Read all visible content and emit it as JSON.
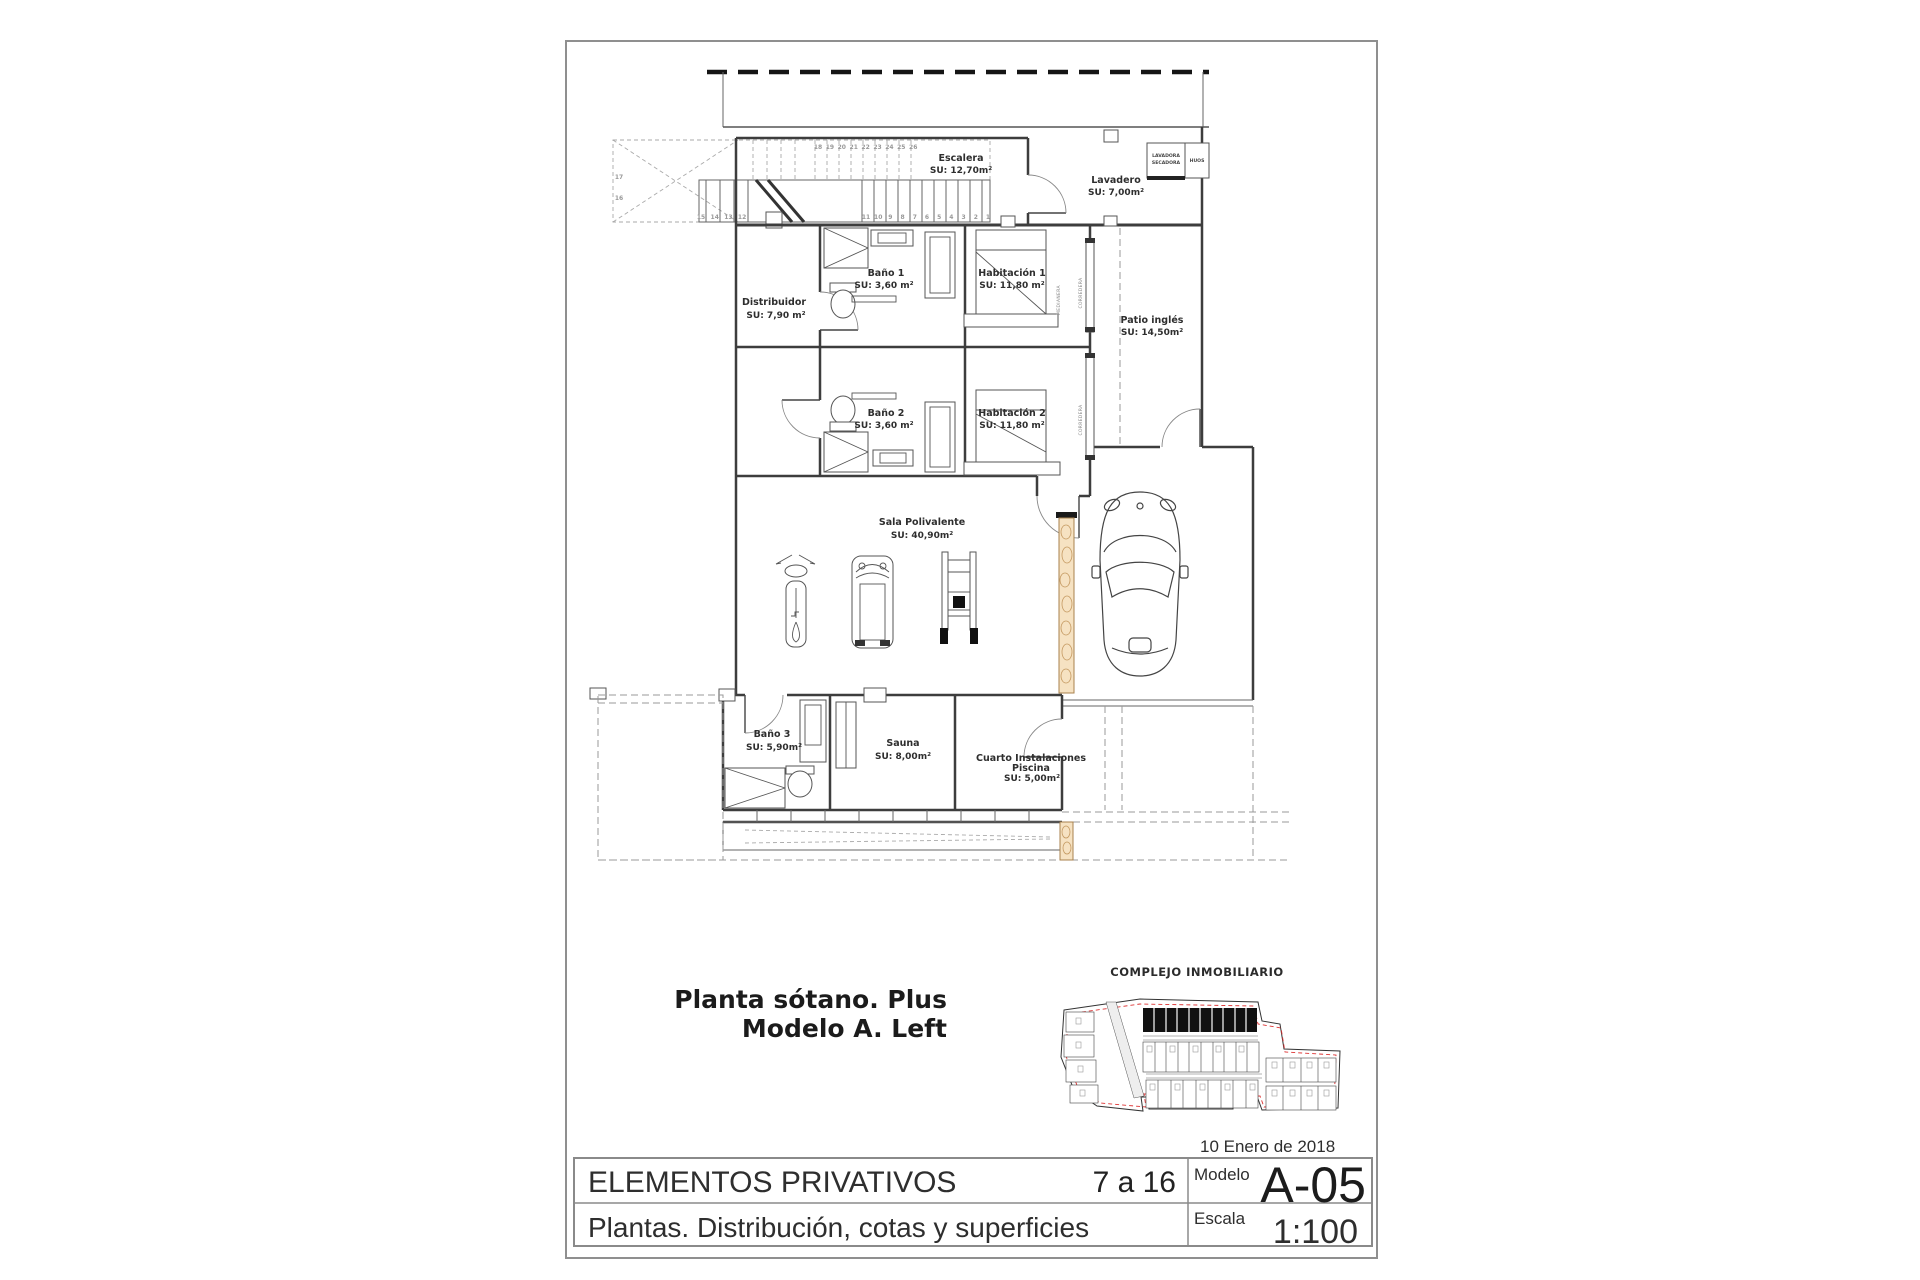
{
  "page": {
    "plan_title_line1": "Planta sótano. Plus",
    "plan_title_line2": "Modelo A. Left",
    "site_plan_title": "COMPLEJO INMOBILIARIO",
    "title_block": {
      "date": "10 Enero de 2018",
      "project": "ELEMENTOS PRIVATIVOS",
      "sheet_range": "7 a 16",
      "modelo_label": "Modelo",
      "modelo_value": "A-05",
      "subtitle": "Plantas. Distribución, cotas y superficies",
      "escala_label": "Escala",
      "escala_value": "1:100",
      "accent_color": "#f4470a"
    }
  },
  "plan": {
    "rooms": {
      "escalera": {
        "name": "Escalera",
        "area": "SU: 12,70m²"
      },
      "lavadero": {
        "name": "Lavadero",
        "area": "SU: 7,00m²"
      },
      "distribuidor": {
        "name": "Distribuidor",
        "area": "SU: 7,90 m²"
      },
      "bano1": {
        "name": "Baño 1",
        "area": "SU: 3,60 m²"
      },
      "habitacion1": {
        "name": "Habitación 1",
        "area": "SU: 11,80 m²"
      },
      "patio": {
        "name": "Patio inglés",
        "area": "SU: 14,50m²"
      },
      "bano2": {
        "name": "Baño 2",
        "area": "SU: 3,60 m²"
      },
      "habitacion2": {
        "name": "Habitación 2",
        "area": "SU: 11,80 m²"
      },
      "sala": {
        "name": "Sala Polivalente",
        "area": "SU: 40,90m²"
      },
      "bano3": {
        "name": "Baño 3",
        "area": "SU: 5,90m²"
      },
      "sauna": {
        "name": "Sauna",
        "area": "SU: 8,00m²"
      },
      "cuarto": {
        "name_line1": "Cuarto Instalaciones",
        "name_line2": "Piscina",
        "area": "SU: 5,00m²"
      }
    },
    "closet": {
      "line1": "LAVADORA",
      "line2": "SECADORA",
      "side": "HUOS"
    },
    "wall_labels": {
      "medianera": "MEDIANERA",
      "corredera": "CORREDERA"
    },
    "stairs": {
      "top_numbers": [
        "18",
        "19",
        "20",
        "21",
        "22",
        "23",
        "24",
        "25",
        "26"
      ],
      "side_numbers": [
        "17",
        "16"
      ],
      "left_numbers": [
        "15",
        "14",
        "13",
        "12"
      ],
      "right_numbers": [
        "11",
        "10",
        "9",
        "8",
        "7",
        "6",
        "5",
        "4",
        "3",
        "2",
        "1"
      ]
    }
  }
}
